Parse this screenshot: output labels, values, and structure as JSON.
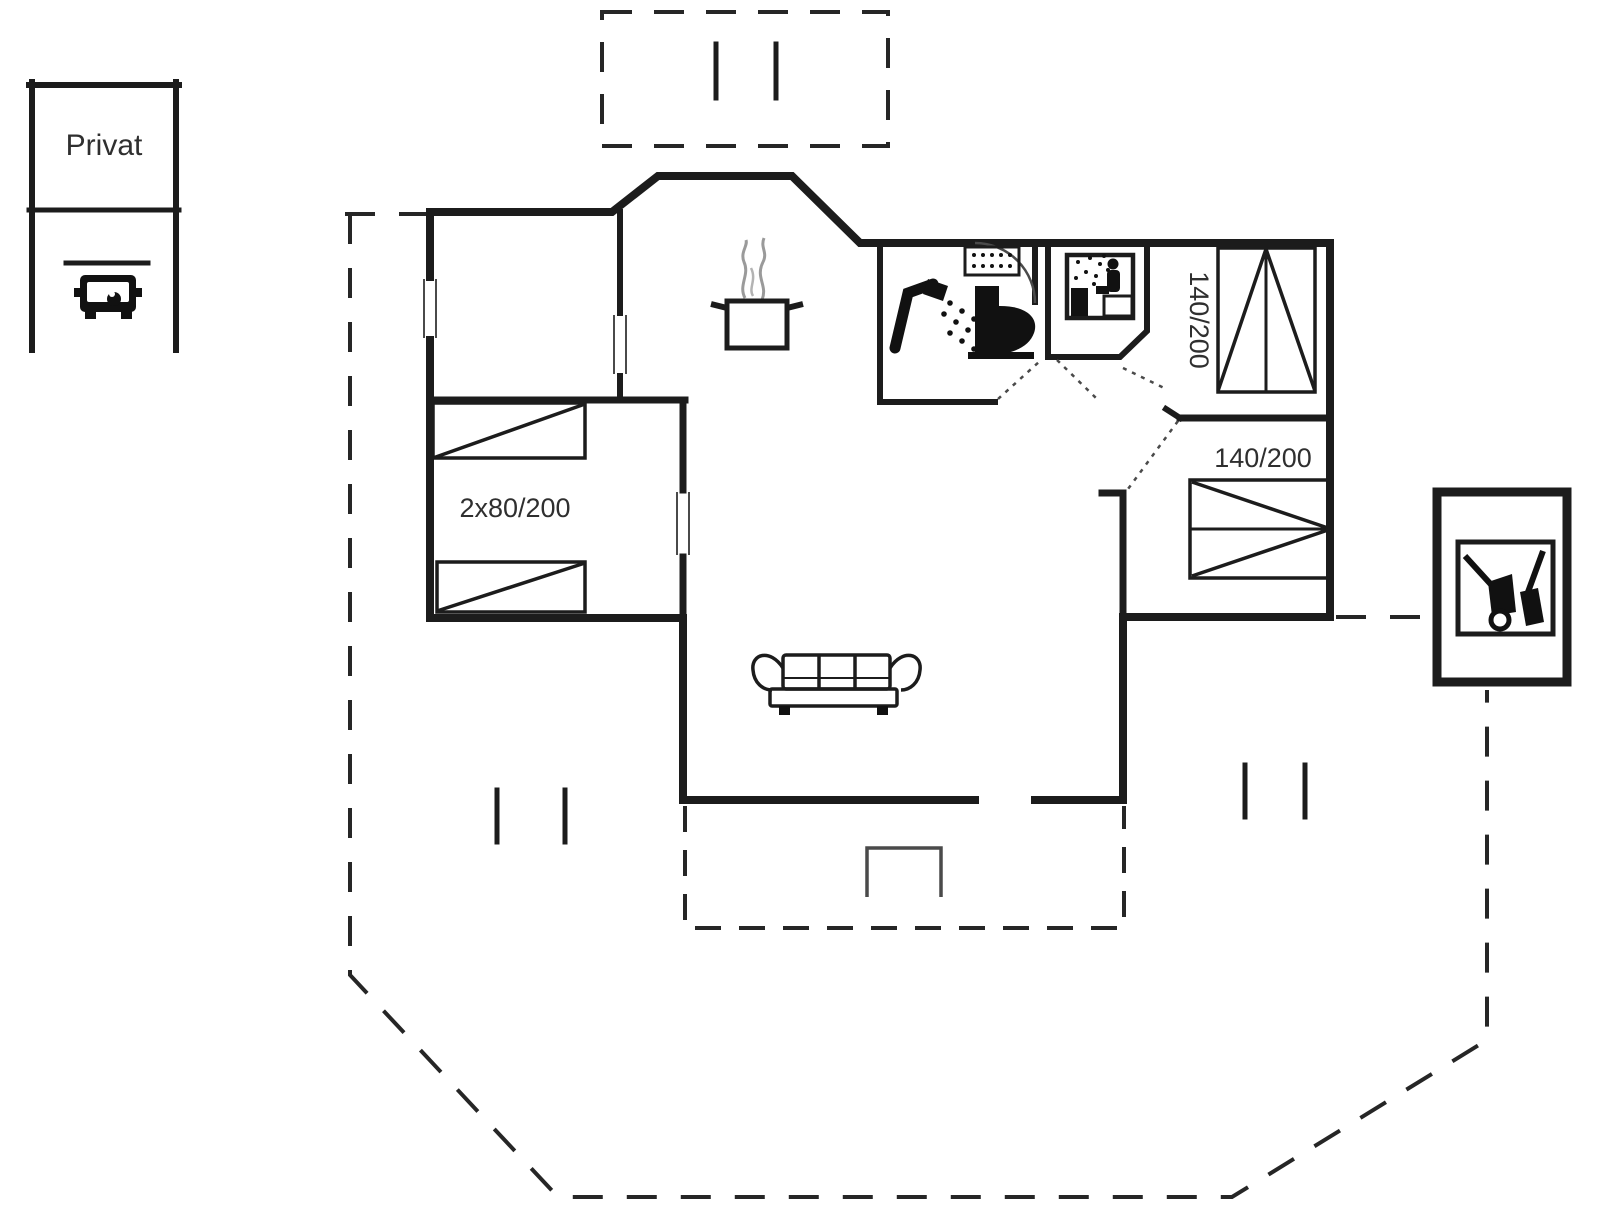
{
  "plan": {
    "title_hint": "holiday-house-floor-plan",
    "ink_color": "#1c1c1c",
    "steam_color": "#9a9a9a",
    "background": "#ffffff"
  },
  "parking": {
    "label": "Privat",
    "icon": "car-icon"
  },
  "beds": [
    {
      "room": "bedroom-left",
      "size": "2x80/200",
      "orientation": "horizontal-two-single-beds"
    },
    {
      "room": "bedroom-top-right",
      "size": "140/200",
      "orientation": "vertical-double-bed"
    },
    {
      "room": "bedroom-middle-right",
      "size": "140/200",
      "orientation": "horizontal-double-bed"
    }
  ],
  "rooms": {
    "kitchen": {
      "icon": "cooking-pot-icon"
    },
    "bathroom": {
      "icons": [
        "shower-icon",
        "toilet-icon",
        "sink-icon"
      ]
    },
    "sauna": {
      "icon": "sauna-icon"
    },
    "living_room": {
      "icon": "sofa-icon"
    },
    "shed": {
      "icon": "garden-tools-icon"
    },
    "terraces": {
      "style": "dashed-outline",
      "markers": "step-marks"
    }
  }
}
